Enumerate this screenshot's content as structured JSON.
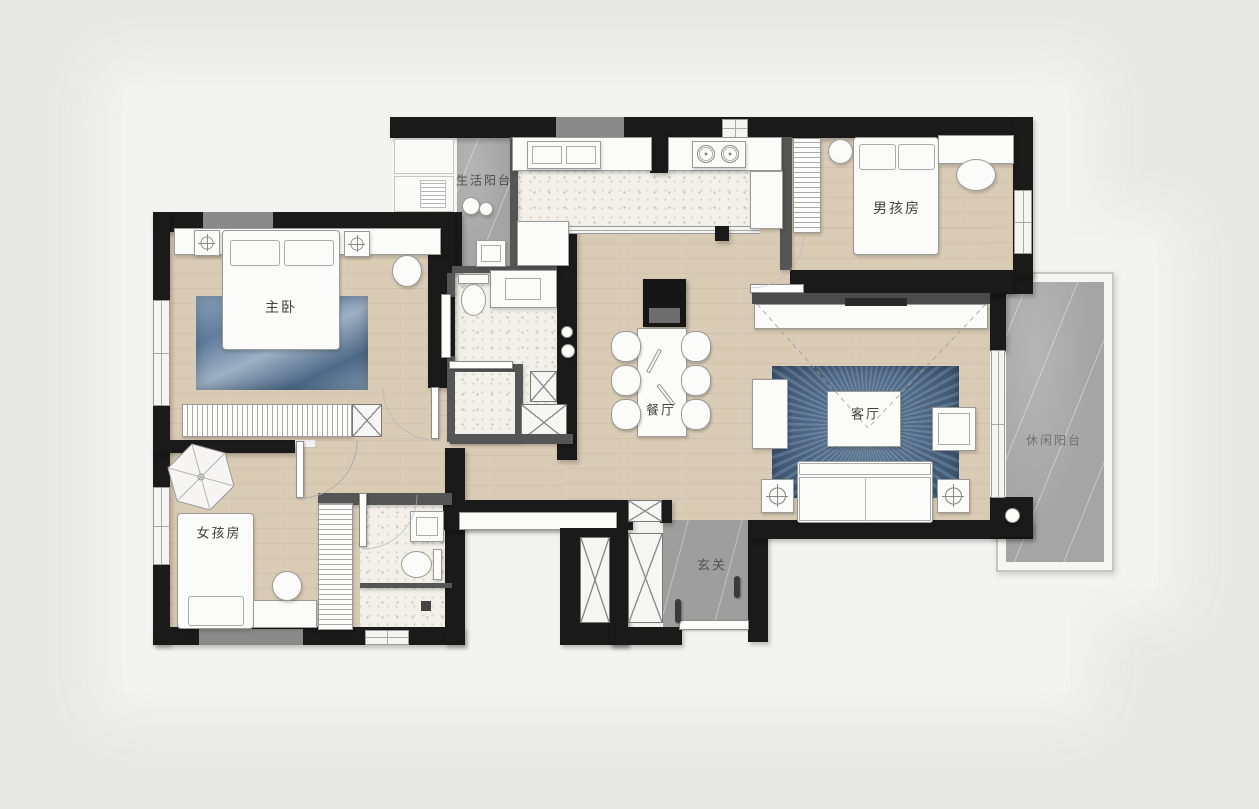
{
  "rooms": {
    "laundry_balcony": {
      "label": "生活阳台"
    },
    "boys_room": {
      "label": "男孩房"
    },
    "master_bedroom": {
      "label": "主卧"
    },
    "dining_room": {
      "label": "餐厅"
    },
    "living_room": {
      "label": "客厅"
    },
    "leisure_balcony": {
      "label": "休闲阳台"
    },
    "girls_room": {
      "label": "女孩房"
    },
    "foyer": {
      "label": "玄关"
    }
  },
  "colors": {
    "background": "#e8e8e7",
    "slab": "#f3f3f1",
    "wall": "#1a1a1a",
    "wall_gray": "#8a8a8a",
    "wood": "#d9cbb4",
    "tile": "#f2f0e9",
    "marble": "#a5a5a5",
    "marble_dark": "#9e9e9e",
    "rug_blue": "#5d7996",
    "furniture": "#fbfbfa",
    "outline": "#9a9a9a",
    "label": "#404040"
  }
}
